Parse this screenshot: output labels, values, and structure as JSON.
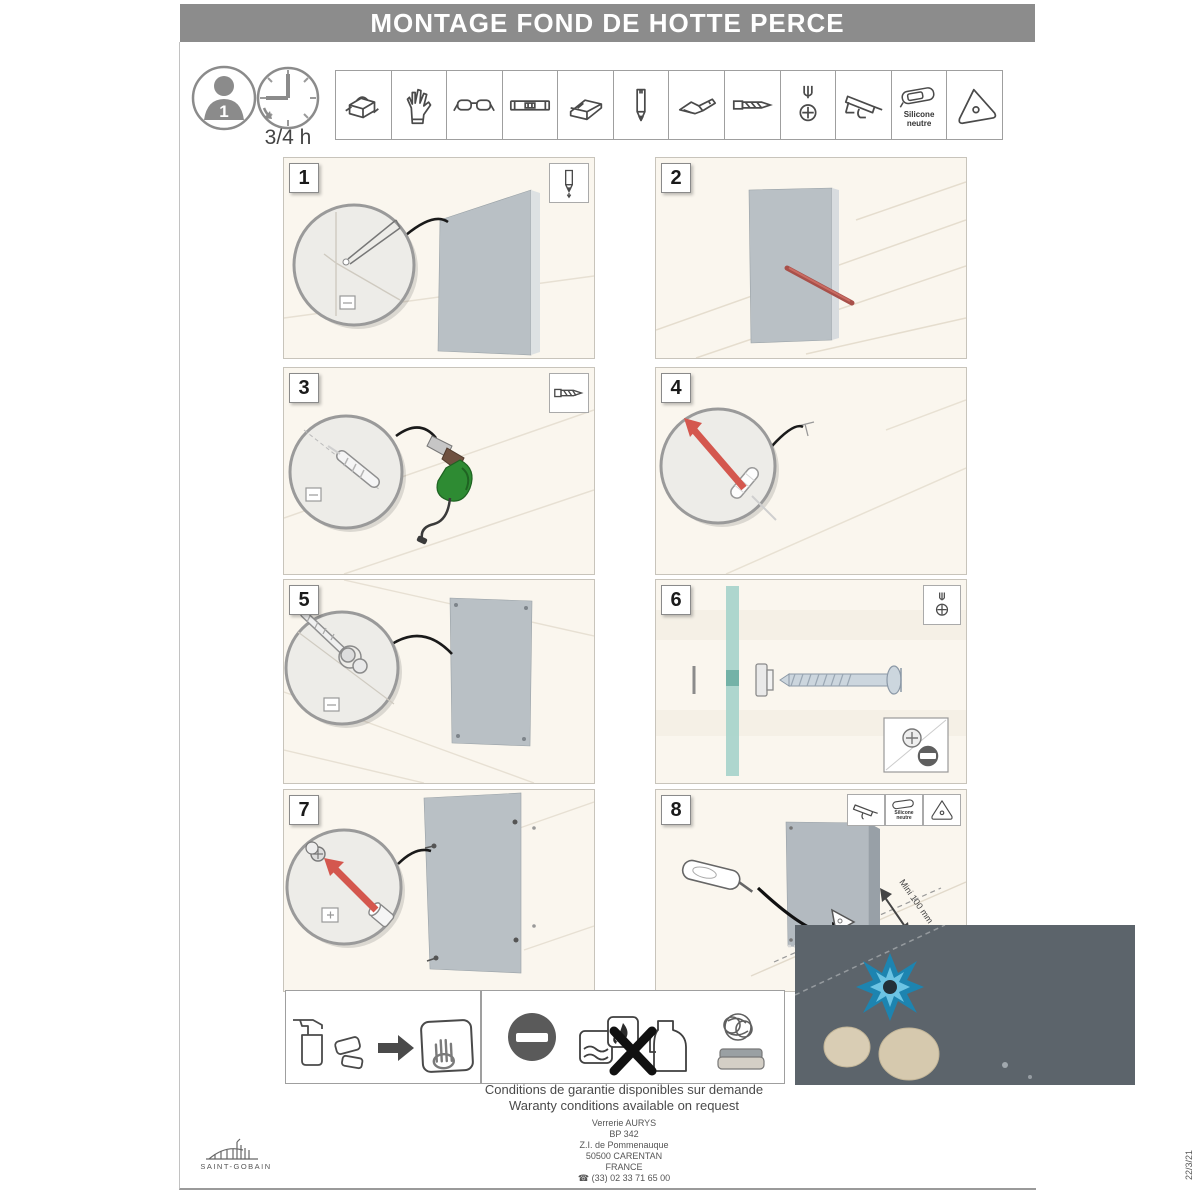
{
  "header": {
    "title": "MONTAGE FOND DE HOTTE PERCE"
  },
  "prep": {
    "people": "1",
    "duration": "3/4 h"
  },
  "tools": {
    "icons": [
      "toolbox",
      "work-gloves",
      "safety-glasses",
      "spirit-level",
      "corner-square",
      "pencil",
      "cutter-knife",
      "drill-bit",
      "phillips-screwdriver",
      "caulking-gun",
      "neutral-silicone-tube",
      "triangle-smoother"
    ],
    "silicone_label_1": "Silicone",
    "silicone_label_2": "neutre"
  },
  "steps": [
    {
      "number": "1",
      "tool_icon": "pencil"
    },
    {
      "number": "2"
    },
    {
      "number": "3",
      "tool_icon": "drill-bit"
    },
    {
      "number": "4"
    },
    {
      "number": "5"
    },
    {
      "number": "6",
      "tool_icon": "phillips-screwdriver"
    },
    {
      "number": "7"
    },
    {
      "number": "8",
      "tool_icons": "caulking-gun, silicone-tube, triangle-smoother",
      "annotation": "Mini 100 mm"
    }
  ],
  "care": {
    "clean_icons": "spray-cleaner, sponge, soft-cloth-hand",
    "forbidden_icons": "prohibition-sign, no-abrasive-product, no-flammable-solvent, no-solvent-jug, no-steel-wool, no-scouring-pad"
  },
  "colors": {
    "banner_gray": "#8c8c8c",
    "glass_gray": "#b9c0c5",
    "accent_red": "#d4574e",
    "glass_teal": "#a5d3ca",
    "flame_blue": "#1d84b0"
  },
  "footer": {
    "warranty_fr": "Conditions de garantie disponibles sur demande",
    "warranty_en": "Waranty conditions available on request",
    "company": "Verrerie AURYS",
    "po_box": "BP 342",
    "street": "Z.I. de Pommenauque",
    "city": "50500 CARENTAN",
    "country": "FRANCE",
    "phone": "☎ (33) 02 33 71 65 00",
    "brand": "SAINT-GOBAIN",
    "date": "22/3/21"
  }
}
